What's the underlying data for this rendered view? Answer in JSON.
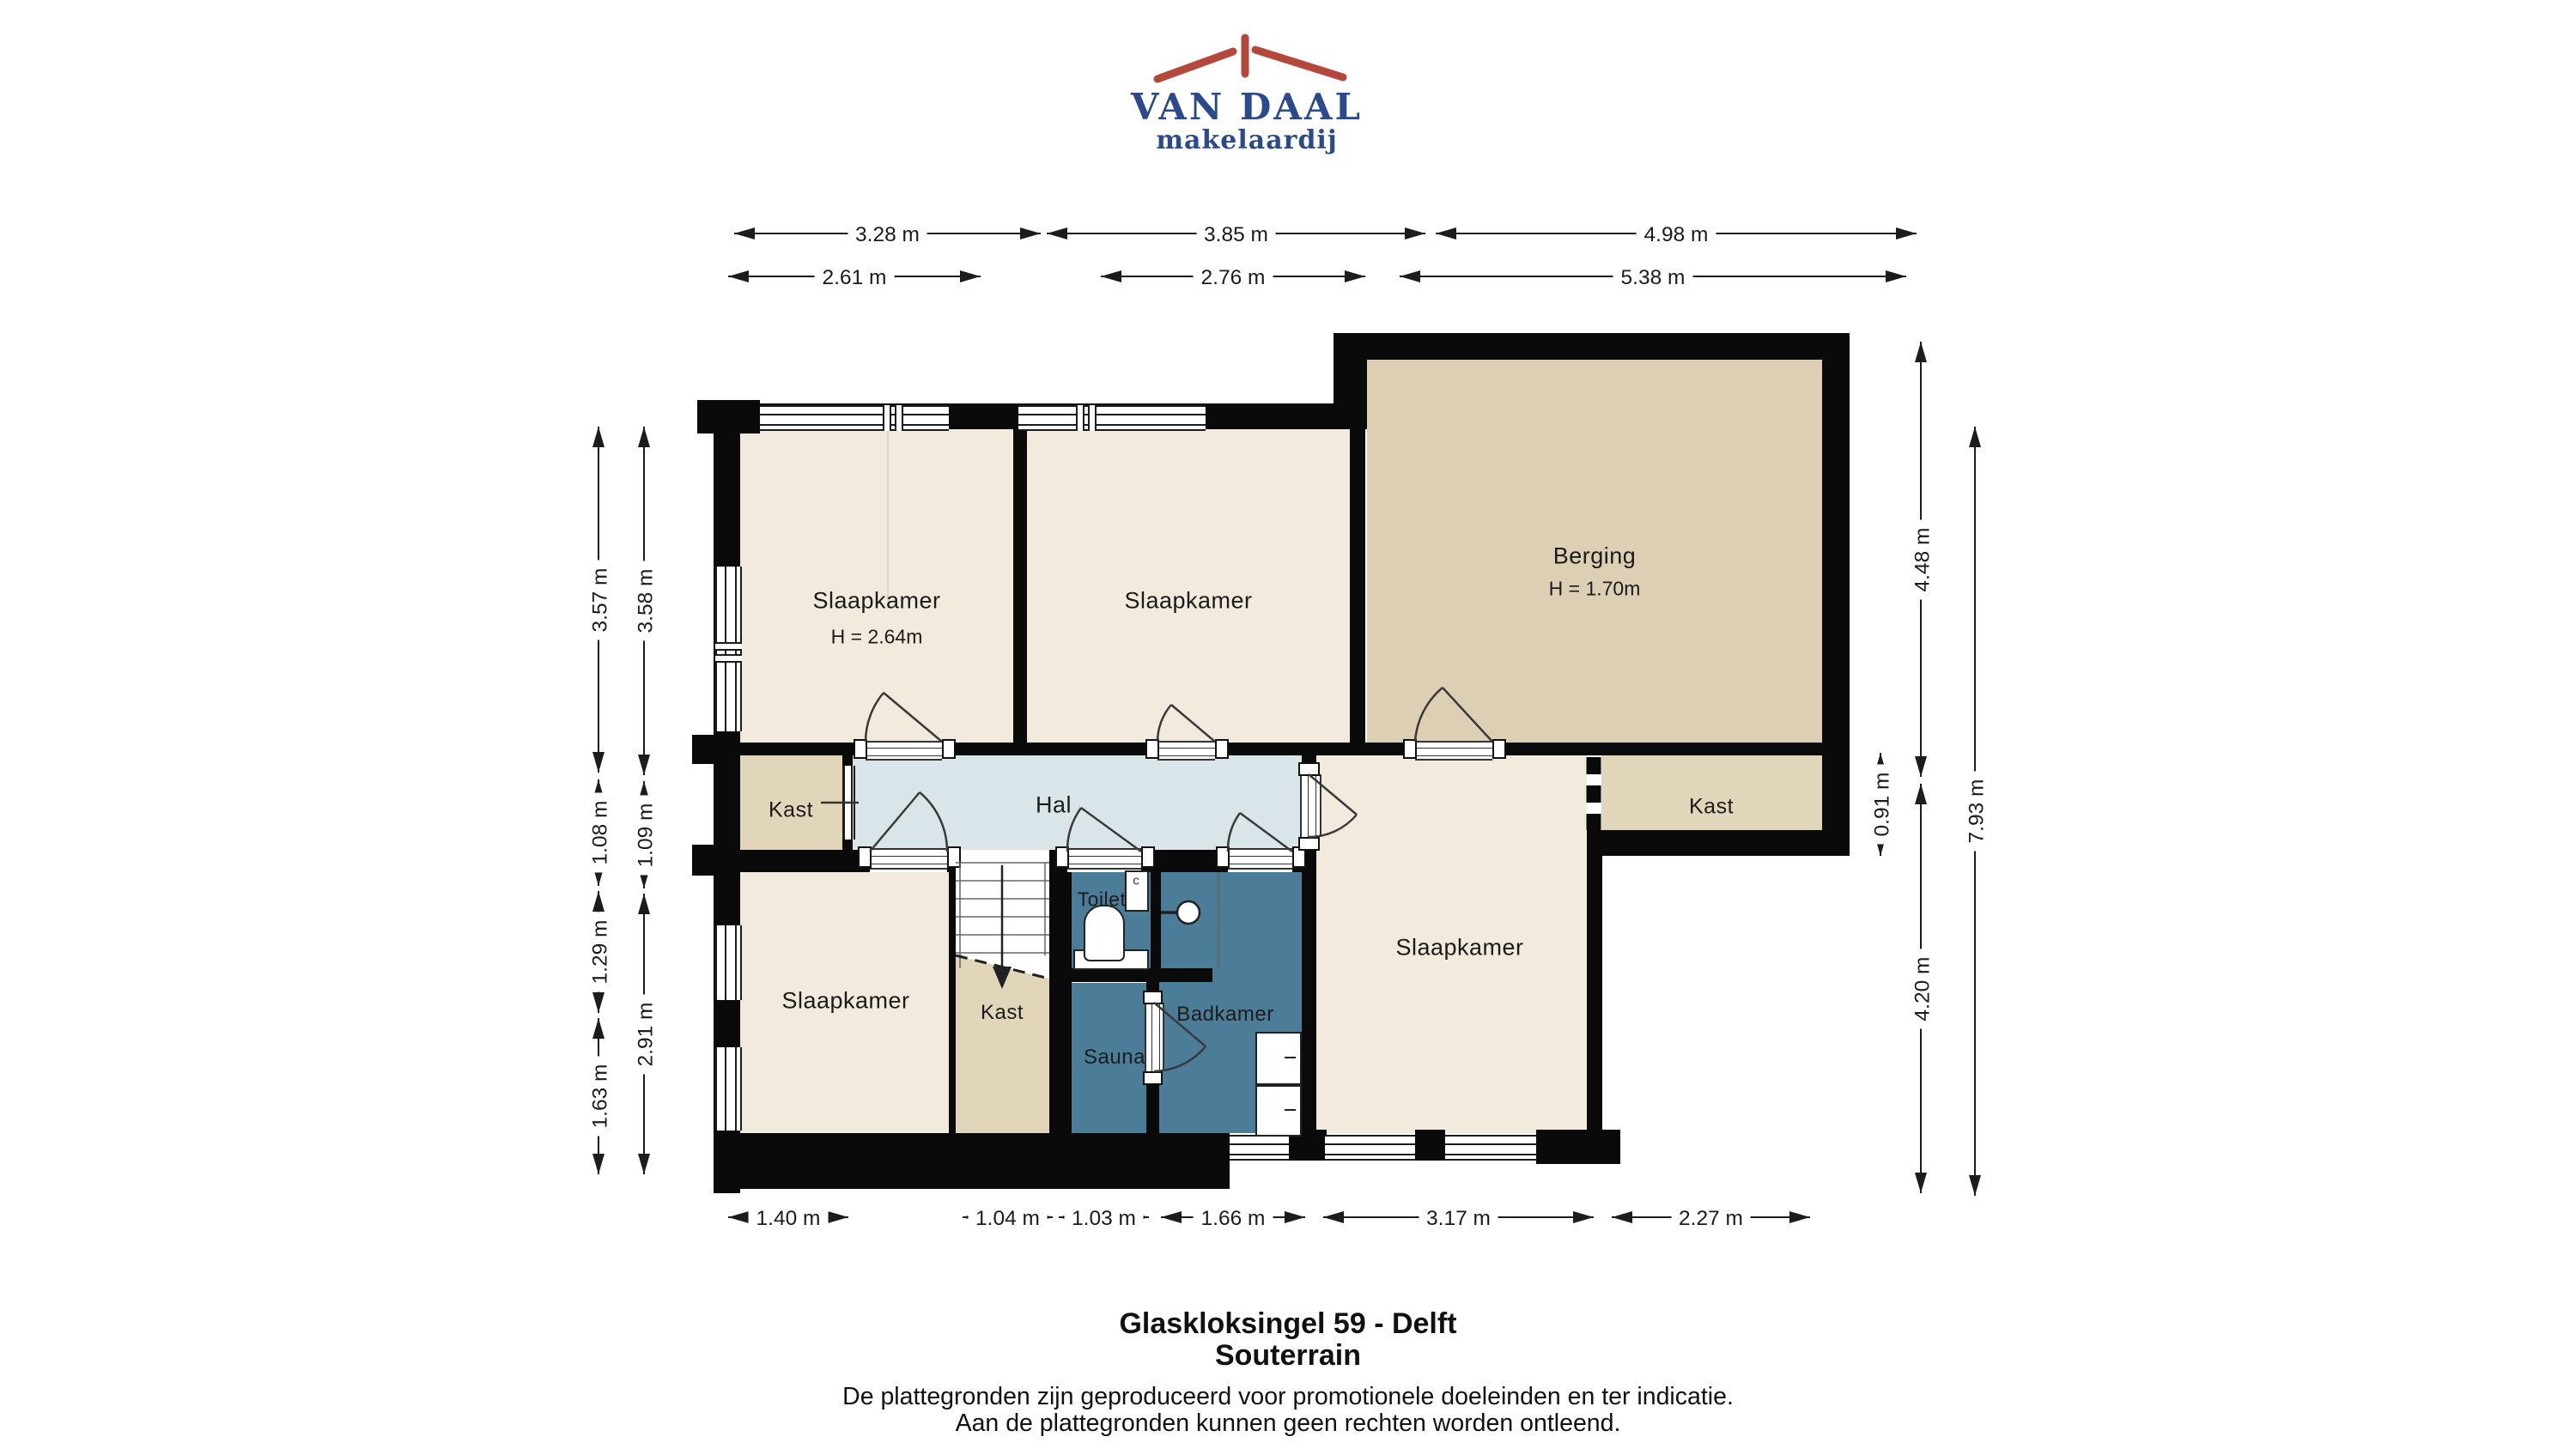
{
  "logo": {
    "name": "VAN DAAL",
    "tagline": "makelaardij",
    "text_color": "#2b4a8b",
    "roof_color": "#b5473c"
  },
  "plan": {
    "rooms": [
      {
        "id": "slaapkamer-nw",
        "label": "Slaapkamer",
        "note": "H = 2.64m"
      },
      {
        "id": "slaapkamer-n",
        "label": "Slaapkamer"
      },
      {
        "id": "berging",
        "label": "Berging",
        "note": "H = 1.70m"
      },
      {
        "id": "kast-west",
        "label": "Kast"
      },
      {
        "id": "hal",
        "label": "Hal"
      },
      {
        "id": "kast-east",
        "label": "Kast"
      },
      {
        "id": "slaapkamer-e",
        "label": "Slaapkamer"
      },
      {
        "id": "slaapkamer-sw",
        "label": "Slaapkamer"
      },
      {
        "id": "kast-stairs",
        "label": "Kast"
      },
      {
        "id": "toilet",
        "label": "Toilet"
      },
      {
        "id": "badkamer",
        "label": "Badkamer"
      },
      {
        "id": "sauna",
        "label": "Sauna"
      }
    ],
    "fixtures": {
      "sink_label": "c"
    },
    "colors": {
      "wall": "#0a0a0a",
      "room": "#f1eadd",
      "closet": "#e2d6ba",
      "storage": "#ddcfb4",
      "hall": "#d9e5e8",
      "wet": "#4b7d99"
    }
  },
  "dimensions": {
    "top_outer": [
      "3.28 m",
      "3.85 m",
      "4.98 m"
    ],
    "top_inner": [
      "2.61 m",
      "2.76 m",
      "5.38 m"
    ],
    "left_outer": [
      "3.57 m",
      "1.08 m",
      "1.29 m",
      "1.63 m"
    ],
    "left_inner": [
      "3.58 m",
      "1.09 m",
      "2.91 m"
    ],
    "right_inner": [
      "4.48 m",
      "4.20 m"
    ],
    "right_outer": [
      "7.93 m"
    ],
    "kast_east": [
      "0.91 m"
    ],
    "bottom": [
      "1.40 m",
      "1.04 m",
      "1.03 m",
      "1.66 m",
      "3.17 m",
      "2.27 m"
    ]
  },
  "footer": {
    "title": "Glaskloksingel 59 - Delft",
    "subtitle": "Souterrain",
    "disclaimer1": "De plattegronden zijn geproduceerd voor promotionele doeleinden en ter indicatie.",
    "disclaimer2": "Aan de plattegronden kunnen geen rechten worden ontleend."
  }
}
